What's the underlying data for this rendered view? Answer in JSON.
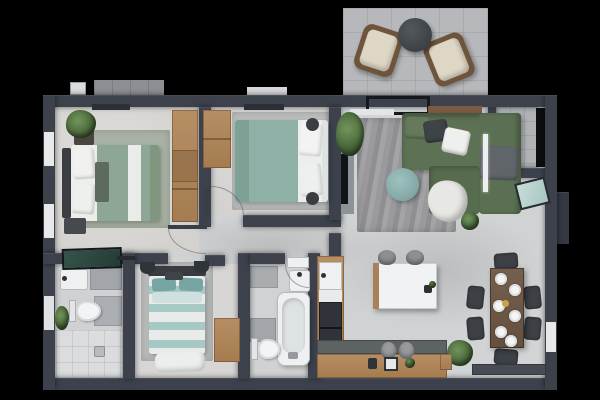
{
  "scene": {
    "type": "3d-rendered-floor-plan",
    "view": "top-down",
    "background_color": "#000000",
    "contains_text": false
  },
  "palette": {
    "outer_wall": "#3c414c",
    "interior_floor": "#d4d5d7",
    "patio_floor": "#b6b8bb",
    "balcony_floor": "#b0b3b6",
    "wood_cabinet": "#b1885e",
    "master_bed_sage": "#8ea695",
    "bedroom2_bed_teal": "#8fb0a6",
    "bedroom3_stripe_teal": "#a6c9c6",
    "sofa_green": "#5d7254",
    "pouf_teal": "#8cb3b0",
    "patio_chair_cream": "#ded7c6",
    "patio_chair_frame": "#6f543c",
    "patio_table_gray": "#43484d",
    "dining_table_wood": "#6e5645",
    "dining_chair_dark": "#3d4146",
    "appliance_dark": "#30343a",
    "bath_fixture_white": "#eef0f1",
    "bath_tile_gray": "#a2a6aa",
    "shower_glass_green": "#2d463e",
    "balcony_glass_teal": "#b9d6d0",
    "doormat_gray": "#474b53",
    "plant_green": "#4d6f3f"
  },
  "rooms": [
    {
      "name": "patio",
      "furniture": [
        "armchair-left",
        "armchair-right",
        "round-coffee-table",
        "tiled-floor"
      ]
    },
    {
      "name": "balcony",
      "furniture": [
        "tiled-floor",
        "dark-glass-panel",
        "tilted-glass-door"
      ]
    },
    {
      "name": "master-bedroom",
      "furniture": [
        "double-bed-sage",
        "area-rug",
        "tall-wardrobe",
        "nightstand",
        "nightstand",
        "potted-plant",
        "curtain-rail",
        "window",
        "window"
      ]
    },
    {
      "name": "bedroom-2",
      "furniture": [
        "double-bed-teal",
        "area-rug",
        "wood-dresser",
        "floor-cushion",
        "floor-cushion",
        "open-door-leaf",
        "curtain-rail"
      ]
    },
    {
      "name": "living-room",
      "furniture": [
        "corner-sofa-green",
        "wood-shelf",
        "area-rug",
        "round-pouf",
        "throw-blanket",
        "tv-panel",
        "tv",
        "potted-plant-large",
        "potted-plant-small",
        "floor-lamp-strip",
        "sliding-door-frame"
      ]
    },
    {
      "name": "hallway",
      "furniture": [
        "door-swing-arc",
        "door-swing-arc",
        "door-swing-arc"
      ]
    },
    {
      "name": "bathroom-1",
      "furniture": [
        "washbasin",
        "toilet",
        "walk-in-shower",
        "floor-drain",
        "potted-plant",
        "shower-glass-panel",
        "wall-tiles"
      ]
    },
    {
      "name": "bedroom-3",
      "furniture": [
        "double-bed-striped",
        "area-rug",
        "wardrobe",
        "wall-sconce",
        "wall-sconce",
        "foot-blanket"
      ]
    },
    {
      "name": "bathroom-2",
      "furniture": [
        "washbasin",
        "toilet",
        "bathtub",
        "towel-shelf",
        "wall-tiles"
      ]
    },
    {
      "name": "kitchen",
      "furniture": [
        "l-shaped-wood-counter",
        "kitchen-sink",
        "fridge-dark",
        "white-island",
        "bar-stool",
        "bar-stool",
        "counter-stool",
        "counter-stool",
        "coffee-machine",
        "counter-plant"
      ]
    },
    {
      "name": "dining-area",
      "furniture": [
        "rect-dining-table",
        "dining-chair",
        "dining-chair",
        "dining-chair",
        "dining-chair",
        "dining-chair",
        "dining-chair",
        "place-plate-x6",
        "centerpiece",
        "entrance-doormat",
        "potted-plant"
      ]
    }
  ]
}
